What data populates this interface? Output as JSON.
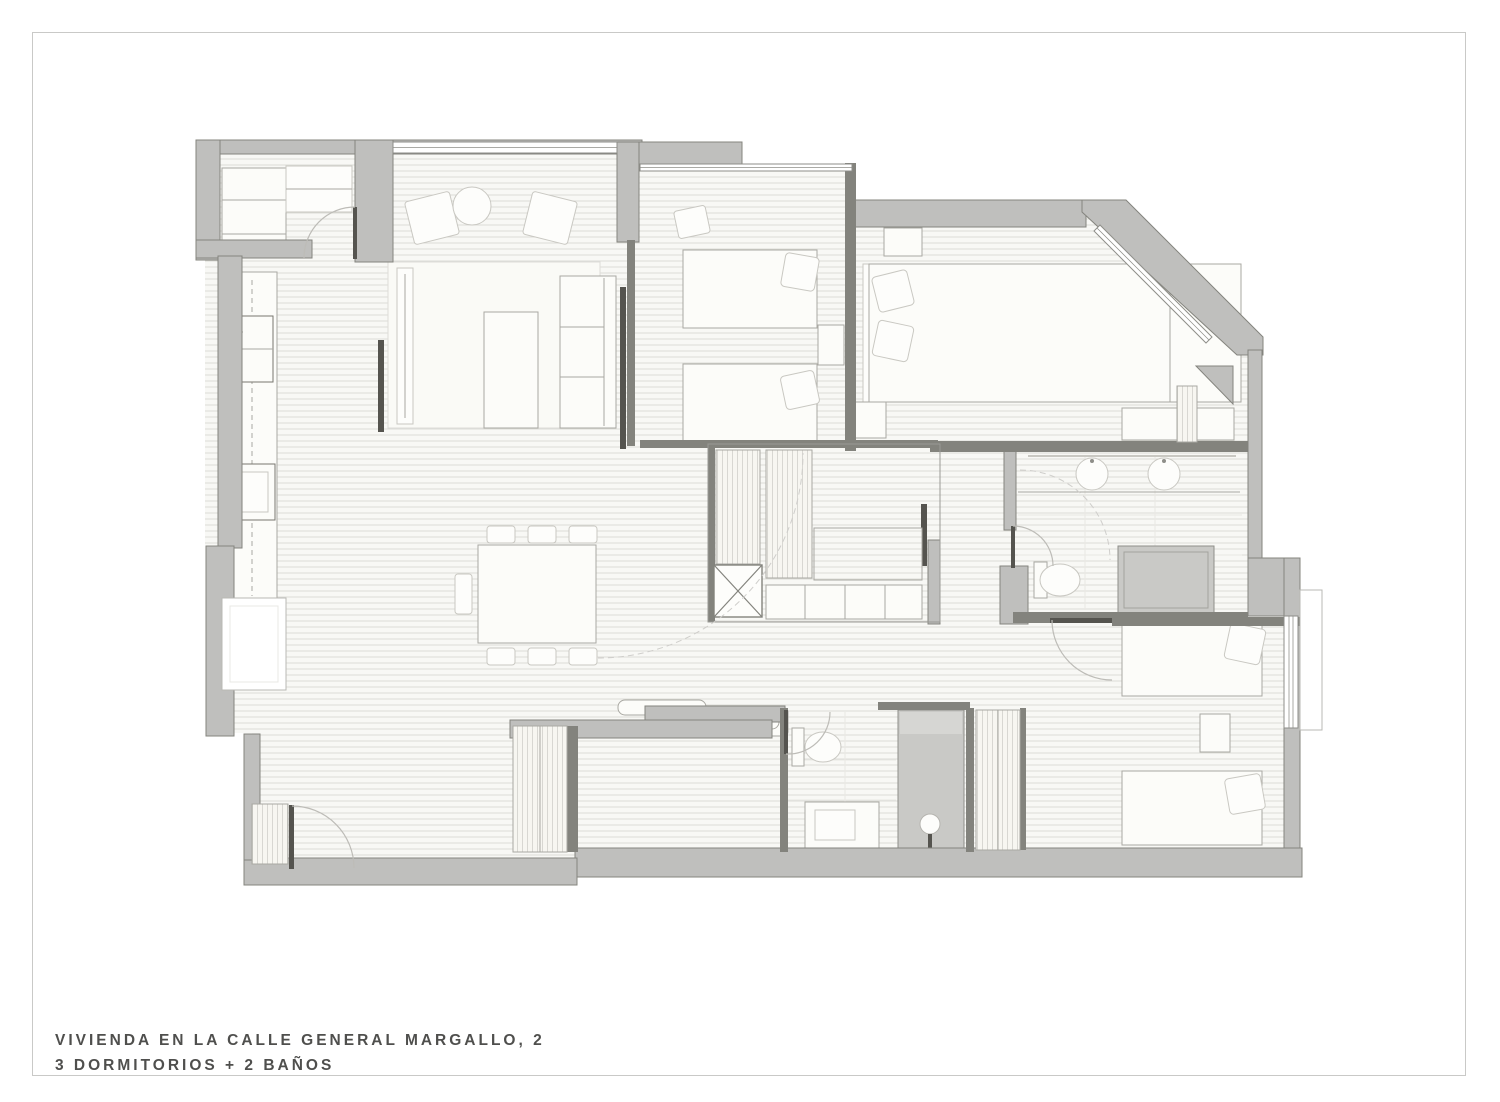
{
  "title_block": {
    "line1": "VIVIENDA EN LA CALLE GENERAL MARGALLO, 2",
    "line2": "3 DORMITORIOS + 2 BAÑOS"
  },
  "plan_colors": {
    "frame": "#c9c9c7",
    "title_text": "#4f4f4d",
    "wall_fill": "#bfbfbd",
    "wall_edge": "#84847e",
    "partition": "#83837d",
    "door_leaf": "#55544f",
    "floor_base": "#f8f8f5",
    "floor_line": "#dcdbd7",
    "furniture_fill": "#fcfcf9",
    "furniture_stroke": "#a9a8a2",
    "shower_fill": "#c9c9c6",
    "window_line": "#8e8e89",
    "arc": "#bdbcb7"
  }
}
